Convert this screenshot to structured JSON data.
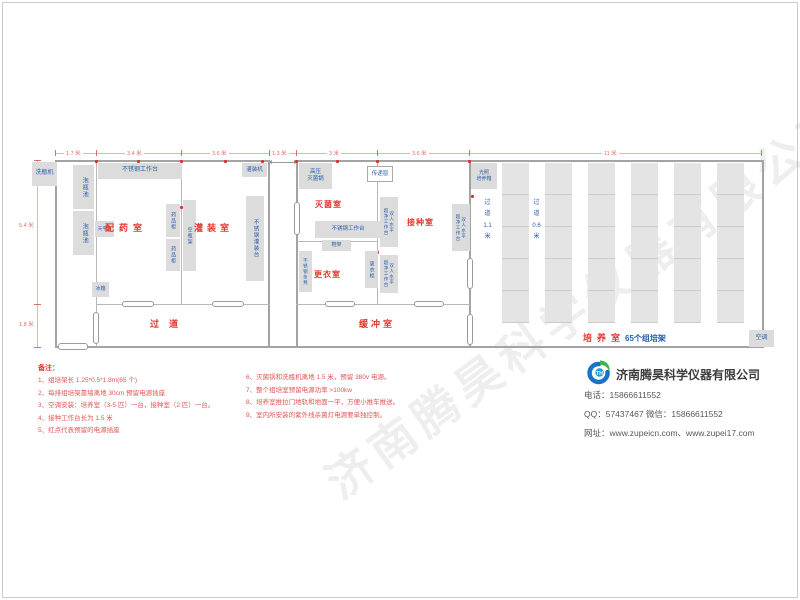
{
  "dims": {
    "top": [
      "1.7 米",
      "3.4 米",
      "3.6 米",
      "1.3 米",
      "3 米",
      "3.6 米",
      "11 米"
    ],
    "left": [
      "5.4 米",
      "1.8 米"
    ]
  },
  "rooms": {
    "prep": "配药室",
    "filling": "灌装室",
    "sterilize": "灭菌室",
    "inoculation": "接种室",
    "changing": "更衣室",
    "corridor": "过道",
    "buffer": "缓冲室",
    "culture": "培养室",
    "culture_sub": "65个组培架"
  },
  "equipment": {
    "bottle_washer": "洗瓶机",
    "soak_pool": "泡瓶池",
    "ss_worktable": "不锈钢工作台",
    "balance_table": "天平台",
    "medicine_cabinet": "药品柜",
    "bottle_rack": "空瓶架",
    "fridge": "冰箱",
    "filling_machine": "灌装机",
    "ss_filling_table": "不锈钢灌装台",
    "autoclave": "高压\n灭菌锅",
    "pass_window": "传递窗",
    "shoe_rack": "鞋架",
    "ss_bench": "不锈钢条凳",
    "locker": "更衣柜",
    "clean_bench": "双人水平\n超净工作台",
    "light_incubator": "光照\n培养箱",
    "air_conditioner": "空调",
    "aisle_wide": "过道 1.1 米",
    "aisle_narrow": "过道 0.6 米"
  },
  "notes": {
    "title": "备注：",
    "left": [
      "1、组培架长 1.25*0.5*1.8m(65 个)",
      "2、每排组培架靠墙离地 30cm 预留电源插座",
      "3、空调安装：培养室（3-5 匹）一台，接种室（2 匹）一台。",
      "4、接种工作台长为 1.5 米",
      "5、红点代表预留的电源插座"
    ],
    "right": [
      "6、灭菌锅和洗瓶机离地 1.5 米，预留 380v 电源。",
      "7、整个组培室预留电源功率 >100kw",
      "8、培养室推拉门地轨和地面一平，方便小推车推送。",
      "9、室内所安装的紫外线杀菌灯电源要单独控制。"
    ]
  },
  "company": {
    "name": "济南腾昊科学仪器有限公司",
    "phone": "电话：15866611552",
    "qq": "QQ：57437467  微信：15866611552",
    "web": "网址：www.zupeicn.com、www.zupei17.com",
    "logo_text": "TH"
  },
  "watermark": "济南腾昊科学仪器有限公司"
}
